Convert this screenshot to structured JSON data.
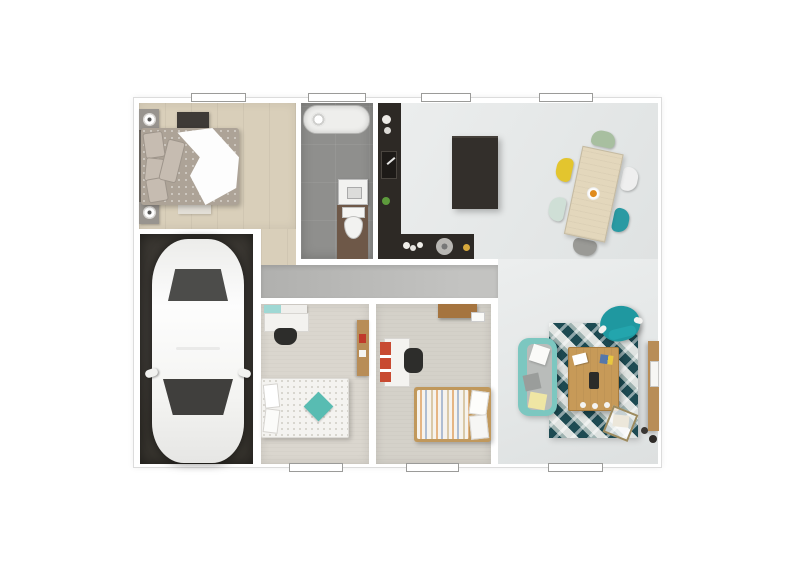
{
  "image_type": "3d-rendered-floor-plan-top-view",
  "title": "single-storey house floor plan render",
  "colors": {
    "page_bg": "#ffffff",
    "wall": "#ffffff",
    "outline": "#dcdcdc",
    "wood_floor": "#d9cfba",
    "carpet_a": "#dad6ce",
    "carpet_b": "#d4d1c9",
    "tile": "#8f8f8d",
    "open_floor": "#e4e7e7",
    "corridor": "#c3c3c1",
    "garage": "#38352f",
    "counter": "#2d2925",
    "island": "#332f2b",
    "cabinet_wood": "#6e5848",
    "furn_wood": "#b88d57",
    "shelf_wood": "#a5743f",
    "bedframe_wood": "#c0985c",
    "coffee_wood": "#c79a58",
    "table_wood": "#e3d7bc",
    "bed1_duvet": "#ada397",
    "teal": "#9fd8d4",
    "teal_pillow": "#58bcb2",
    "sofa": "#7cc7c0",
    "armchair": "#1f98a0",
    "rug_dark": "#1d4a52",
    "rug_light": "#dfe3e1",
    "red_shelf": "#c84a31",
    "pillow_yellow": "#efe6a4",
    "chair_green": "#a8bfa0",
    "chair_white": "#efefef",
    "chair_teal": "#2a9aa3",
    "chair_gray": "#9a9a96",
    "chair_mint": "#cfdfd6",
    "chair_yellow": "#e3c52e"
  },
  "rooms": [
    {
      "id": "bedroom-1",
      "position": "top-left",
      "floor": "light wood planks",
      "furniture": [
        "double-bed with patterned duvet and white throw",
        "nightstand with lamp (x2)",
        "dark dresser",
        "bench at foot of bed"
      ]
    },
    {
      "id": "bathroom",
      "position": "top-center",
      "floor": "gray tile",
      "furniture": [
        "bathtub",
        "washbasin",
        "toilet on wood vanity"
      ]
    },
    {
      "id": "kitchen",
      "position": "top-center-right",
      "floor": "light gray",
      "furniture": [
        "L-shaped dark counter",
        "sink",
        "dark island",
        "dishes",
        "pan",
        "plant"
      ]
    },
    {
      "id": "dining-area",
      "position": "top-right",
      "floor": "light gray",
      "furniture": [
        "rotated wood dining table",
        "6 mixed-color chairs (green, white, teal, gray, mint, yellow)",
        "fruit bowl"
      ]
    },
    {
      "id": "garage",
      "position": "bottom-left",
      "floor": "dark concrete",
      "furniture": [
        "white car (top view)"
      ]
    },
    {
      "id": "hallway",
      "position": "center",
      "floor": "gray",
      "furniture": []
    },
    {
      "id": "bedroom-2",
      "position": "bottom-center-left",
      "floor": "beige carpet",
      "furniture": [
        "single bed with dotted white duvet and teal pillow",
        "white desk",
        "black chair",
        "teal wall shelf",
        "wood wardrobe"
      ]
    },
    {
      "id": "bedroom-3",
      "position": "bottom-center-right",
      "floor": "gray carpet",
      "furniture": [
        "single bed with striped duvet",
        "white desk",
        "red shelf unit",
        "black chair",
        "wood wall shelf"
      ]
    },
    {
      "id": "living-room",
      "position": "bottom-right",
      "floor": "light gray",
      "furniture": [
        "teal sofa with pillows",
        "geometric teal rug",
        "wood coffee table",
        "teal saucer armchair",
        "wood TV sideboard",
        "magazine basket"
      ]
    }
  ],
  "windows": [
    {
      "wall": "top",
      "room": "bedroom-1"
    },
    {
      "wall": "top",
      "room": "bathroom"
    },
    {
      "wall": "top",
      "room": "kitchen"
    },
    {
      "wall": "top",
      "room": "dining-area"
    },
    {
      "wall": "bottom",
      "room": "bedroom-2"
    },
    {
      "wall": "bottom",
      "room": "bedroom-3"
    },
    {
      "wall": "bottom",
      "room": "living-room"
    }
  ]
}
